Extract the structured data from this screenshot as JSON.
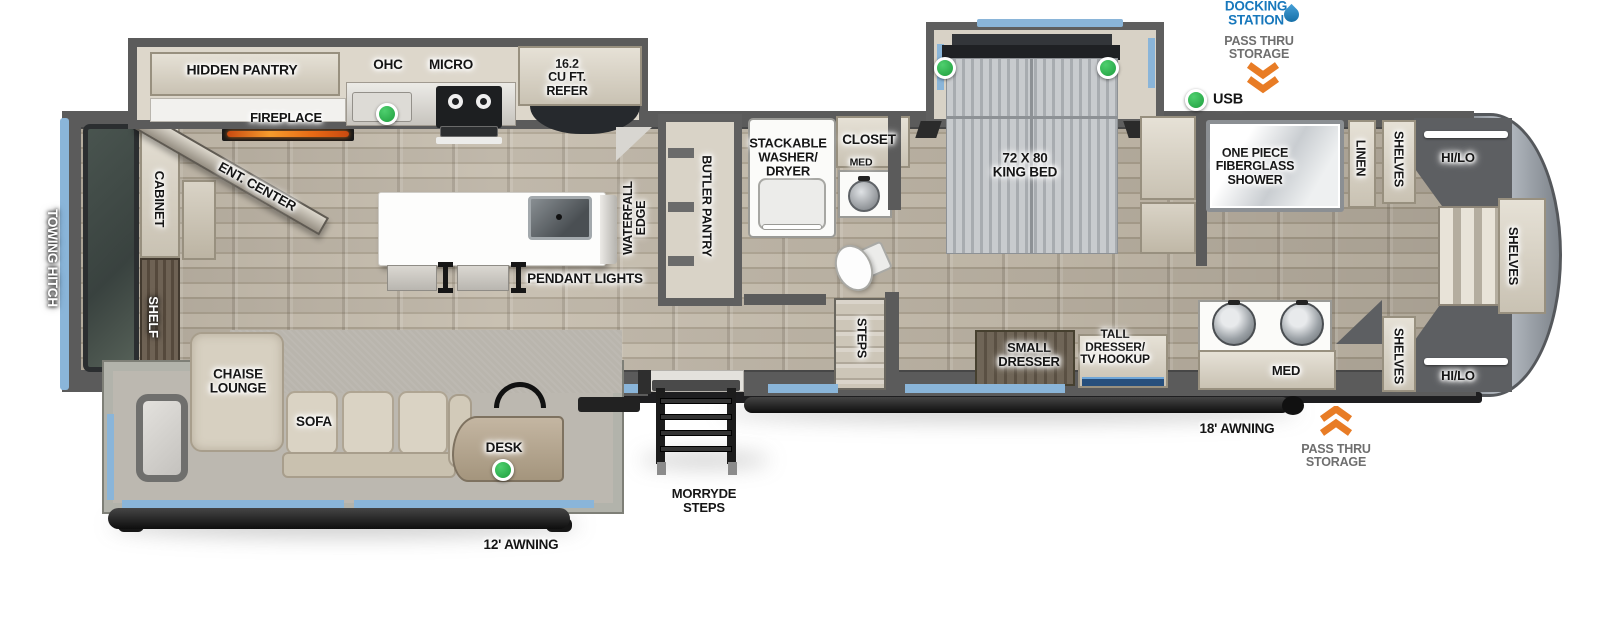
{
  "title": "RV fifth-wheel floor plan",
  "colors": {
    "accent_blue": "#8ab5d9",
    "label_blue": "#1878bc",
    "label_gray": "#6f6f6f",
    "marker_green": "#2eb04a",
    "orange_arrow": "#e87c25",
    "wall_gray": "#5b5b5b",
    "awning_black": "#141414",
    "floor_wood": "#b3aa9c",
    "furniture_beige": "#d6cfc0"
  },
  "icons": [
    "water-drop-icon",
    "double-chevron-down-icon",
    "double-chevron-up-icon",
    "green-dot-marker"
  ],
  "labels": [
    {
      "id": "docking-station",
      "text": "DOCKING\nSTATION",
      "x": 1256,
      "y": 14,
      "rot": 0,
      "theme": "blue",
      "size": 13.5
    },
    {
      "id": "pass-thru-storage-top",
      "text": "PASS THRU\nSTORAGE",
      "x": 1259,
      "y": 48,
      "rot": 0,
      "theme": "gray",
      "size": 12.5
    },
    {
      "id": "usb",
      "text": "USB",
      "x": 1228,
      "y": 100,
      "rot": 0,
      "theme": "dark",
      "size": 14.5
    },
    {
      "id": "hidden-pantry",
      "text": "HIDDEN PANTRY",
      "x": 242,
      "y": 70,
      "rot": 0,
      "theme": "dark",
      "size": 14
    },
    {
      "id": "ohc",
      "text": "OHC",
      "x": 388,
      "y": 65,
      "rot": 0,
      "theme": "dark",
      "size": 13.5
    },
    {
      "id": "micro",
      "text": "MICRO",
      "x": 451,
      "y": 65,
      "rot": 0,
      "theme": "dark",
      "size": 13.5
    },
    {
      "id": "refer",
      "text": "16.2\nCU FT.\nREFER",
      "x": 567,
      "y": 78,
      "rot": 0,
      "theme": "dark",
      "size": 12.5
    },
    {
      "id": "fireplace",
      "text": "FIREPLACE",
      "x": 286,
      "y": 118,
      "rot": 0,
      "theme": "dark",
      "size": 13
    },
    {
      "id": "ent-center",
      "text": "ENT. CENTER",
      "x": 257,
      "y": 187,
      "rot": 29,
      "theme": "dark",
      "size": 13.5
    },
    {
      "id": "cabinet",
      "text": "CABINET",
      "x": 159,
      "y": 199,
      "rot": 90,
      "theme": "dark",
      "size": 13
    },
    {
      "id": "shelf",
      "text": "SHELF",
      "x": 153,
      "y": 317,
      "rot": 90,
      "theme": "light",
      "size": 13
    },
    {
      "id": "towing-hitch",
      "text": "TOWING HITCH",
      "x": 52,
      "y": 258,
      "rot": 90,
      "theme": "light",
      "size": 13.5
    },
    {
      "id": "chaise-lounge",
      "text": "CHAISE\nLOUNGE",
      "x": 238,
      "y": 382,
      "rot": 0,
      "theme": "dark",
      "size": 13.5
    },
    {
      "id": "sofa",
      "text": "SOFA",
      "x": 314,
      "y": 422,
      "rot": 0,
      "theme": "dark",
      "size": 13.5
    },
    {
      "id": "desk",
      "text": "DESK",
      "x": 504,
      "y": 448,
      "rot": 0,
      "theme": "dark",
      "size": 13.5
    },
    {
      "id": "awning-12",
      "text": "12' AWNING",
      "x": 521,
      "y": 545,
      "rot": 0,
      "theme": "dark",
      "size": 13.5
    },
    {
      "id": "morryde-steps",
      "text": "MORRYDE\nSTEPS",
      "x": 704,
      "y": 501,
      "rot": 0,
      "theme": "dark",
      "size": 13
    },
    {
      "id": "waterfall-edge",
      "text": "WATERFALL\nEDGE",
      "x": 635,
      "y": 218,
      "rot": -90,
      "theme": "dark",
      "size": 12.5
    },
    {
      "id": "pendant-lights",
      "text": "PENDANT LIGHTS",
      "x": 585,
      "y": 279,
      "rot": 0,
      "theme": "dark",
      "size": 13.5
    },
    {
      "id": "butler-pantry",
      "text": "BUTLER PANTRY",
      "x": 706,
      "y": 206,
      "rot": 90,
      "theme": "dark",
      "size": 12.5
    },
    {
      "id": "stackable-washer-dryer",
      "text": "STACKABLE\nWASHER/\nDRYER",
      "x": 788,
      "y": 157,
      "rot": 0,
      "theme": "dark",
      "size": 13
    },
    {
      "id": "closet",
      "text": "CLOSET",
      "x": 869,
      "y": 140,
      "rot": 0,
      "theme": "dark",
      "size": 13.5
    },
    {
      "id": "med-bathroom",
      "text": "MED",
      "x": 861,
      "y": 163,
      "rot": 0,
      "theme": "dark",
      "size": 10.5
    },
    {
      "id": "steps",
      "text": "STEPS",
      "x": 861,
      "y": 338,
      "rot": 90,
      "theme": "dark",
      "size": 12.5
    },
    {
      "id": "king-bed",
      "text": "72 X 80\nKING BED",
      "x": 1025,
      "y": 166,
      "rot": 0,
      "theme": "dark",
      "size": 13.5
    },
    {
      "id": "small-dresser",
      "text": "SMALL\nDRESSER",
      "x": 1029,
      "y": 355,
      "rot": 0,
      "theme": "dark",
      "size": 13
    },
    {
      "id": "tall-dresser",
      "text": "TALL\nDRESSER/\nTV HOOKUP",
      "x": 1115,
      "y": 347,
      "rot": 0,
      "theme": "dark",
      "size": 12
    },
    {
      "id": "awning-18",
      "text": "18' AWNING",
      "x": 1237,
      "y": 429,
      "rot": 0,
      "theme": "dark",
      "size": 13.5
    },
    {
      "id": "pass-thru-storage-bottom",
      "text": "PASS THRU\nSTORAGE",
      "x": 1336,
      "y": 456,
      "rot": 0,
      "theme": "gray",
      "size": 12.5
    },
    {
      "id": "shower",
      "text": "ONE PIECE\nFIBERGLASS\nSHOWER",
      "x": 1255,
      "y": 167,
      "rot": 0,
      "theme": "dark",
      "size": 12.5
    },
    {
      "id": "linen",
      "text": "LINEN",
      "x": 1360,
      "y": 158,
      "rot": 90,
      "theme": "dark",
      "size": 12.5
    },
    {
      "id": "shelves-top",
      "text": "SHELVES",
      "x": 1398,
      "y": 159,
      "rot": 90,
      "theme": "dark",
      "size": 12.5
    },
    {
      "id": "hi-lo-top",
      "text": "HI/LO",
      "x": 1458,
      "y": 158,
      "rot": 0,
      "theme": "dark",
      "size": 13
    },
    {
      "id": "shelves-front",
      "text": "SHELVES",
      "x": 1513,
      "y": 256,
      "rot": 90,
      "theme": "dark",
      "size": 13
    },
    {
      "id": "shelves-bottom",
      "text": "SHELVES",
      "x": 1398,
      "y": 356,
      "rot": 90,
      "theme": "dark",
      "size": 12.5
    },
    {
      "id": "hi-lo-bottom",
      "text": "HI/LO",
      "x": 1458,
      "y": 376,
      "rot": 0,
      "theme": "dark",
      "size": 13
    },
    {
      "id": "med-vanity",
      "text": "MED",
      "x": 1286,
      "y": 371,
      "rot": 0,
      "theme": "dark",
      "size": 13
    }
  ],
  "markers": [
    {
      "id": "kitchen-counter-usb",
      "x": 387,
      "y": 114
    },
    {
      "id": "bed-left-usb",
      "x": 945,
      "y": 68
    },
    {
      "id": "bed-right-usb",
      "x": 1108,
      "y": 68
    },
    {
      "id": "exterior-usb",
      "x": 1196,
      "y": 100
    },
    {
      "id": "desk-usb",
      "x": 503,
      "y": 470
    }
  ]
}
